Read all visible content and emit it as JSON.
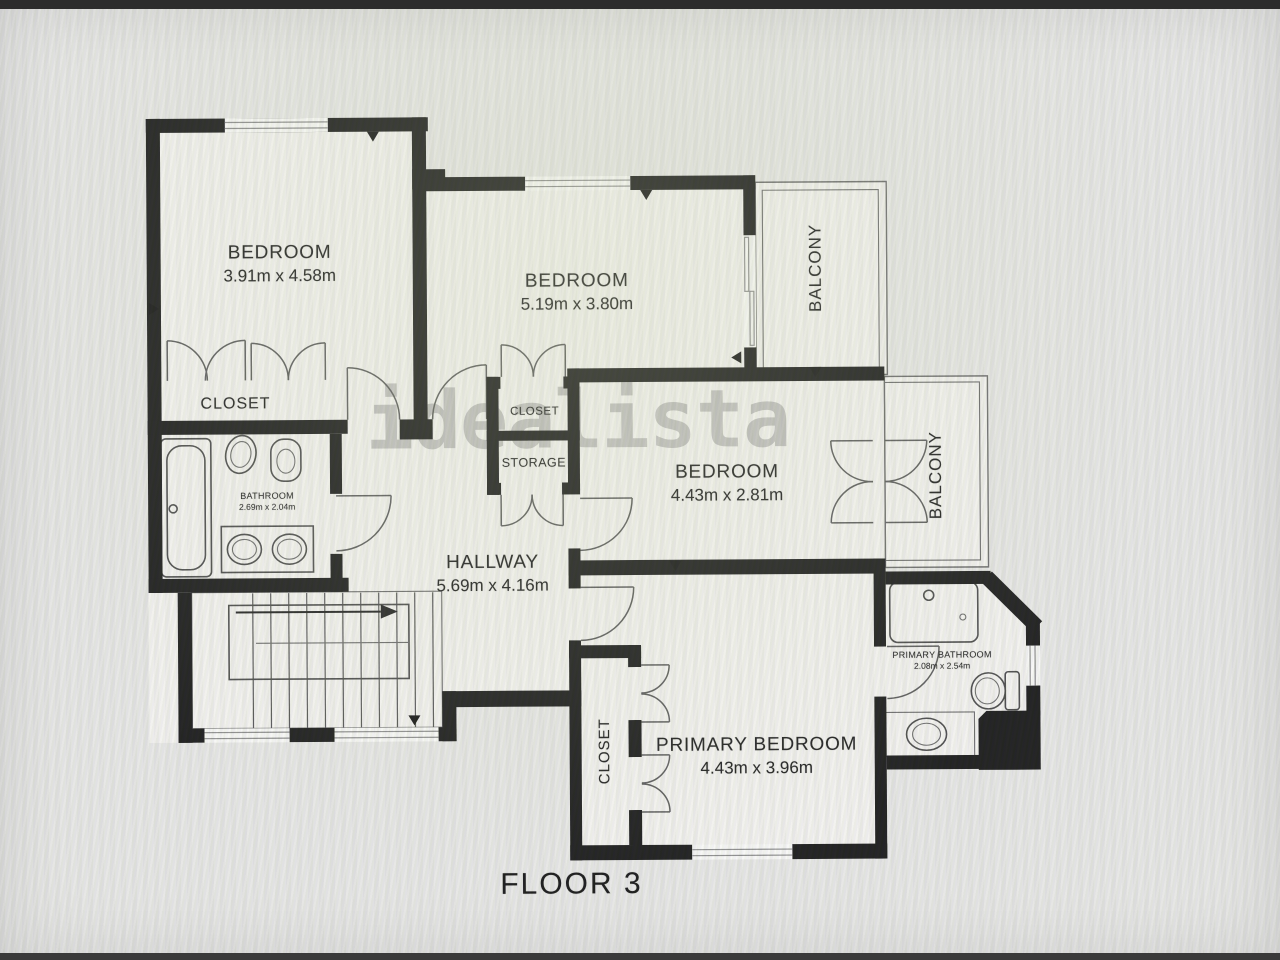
{
  "floor_label": "FLOOR 3",
  "watermark": "idealista",
  "rooms": {
    "bedroom1": {
      "label": "BEDROOM",
      "dims": "3.91m x 4.58m"
    },
    "bedroom2": {
      "label": "BEDROOM",
      "dims": "5.19m x 3.80m"
    },
    "bedroom3": {
      "label": "BEDROOM",
      "dims": "4.43m x 2.81m"
    },
    "primary_bedroom": {
      "label": "PRIMARY BEDROOM",
      "dims": "4.43m x 3.96m"
    },
    "hallway": {
      "label": "HALLWAY",
      "dims": "5.69m x 4.16m"
    },
    "bathroom": {
      "label": "BATHROOM",
      "dims": "2.69m x 2.04m"
    },
    "primary_bathroom": {
      "label": "PRIMARY BATHROOM",
      "dims": "2.08m x 2.54m"
    },
    "closet_bedroom1": {
      "label": "CLOSET"
    },
    "closet_bedroom2": {
      "label": "CLOSET"
    },
    "storage": {
      "label": "STORAGE"
    },
    "closet_primary": {
      "label": "CLOSET"
    },
    "balcony_top": {
      "label": "BALCONY"
    },
    "balcony_middle": {
      "label": "BALCONY"
    }
  }
}
